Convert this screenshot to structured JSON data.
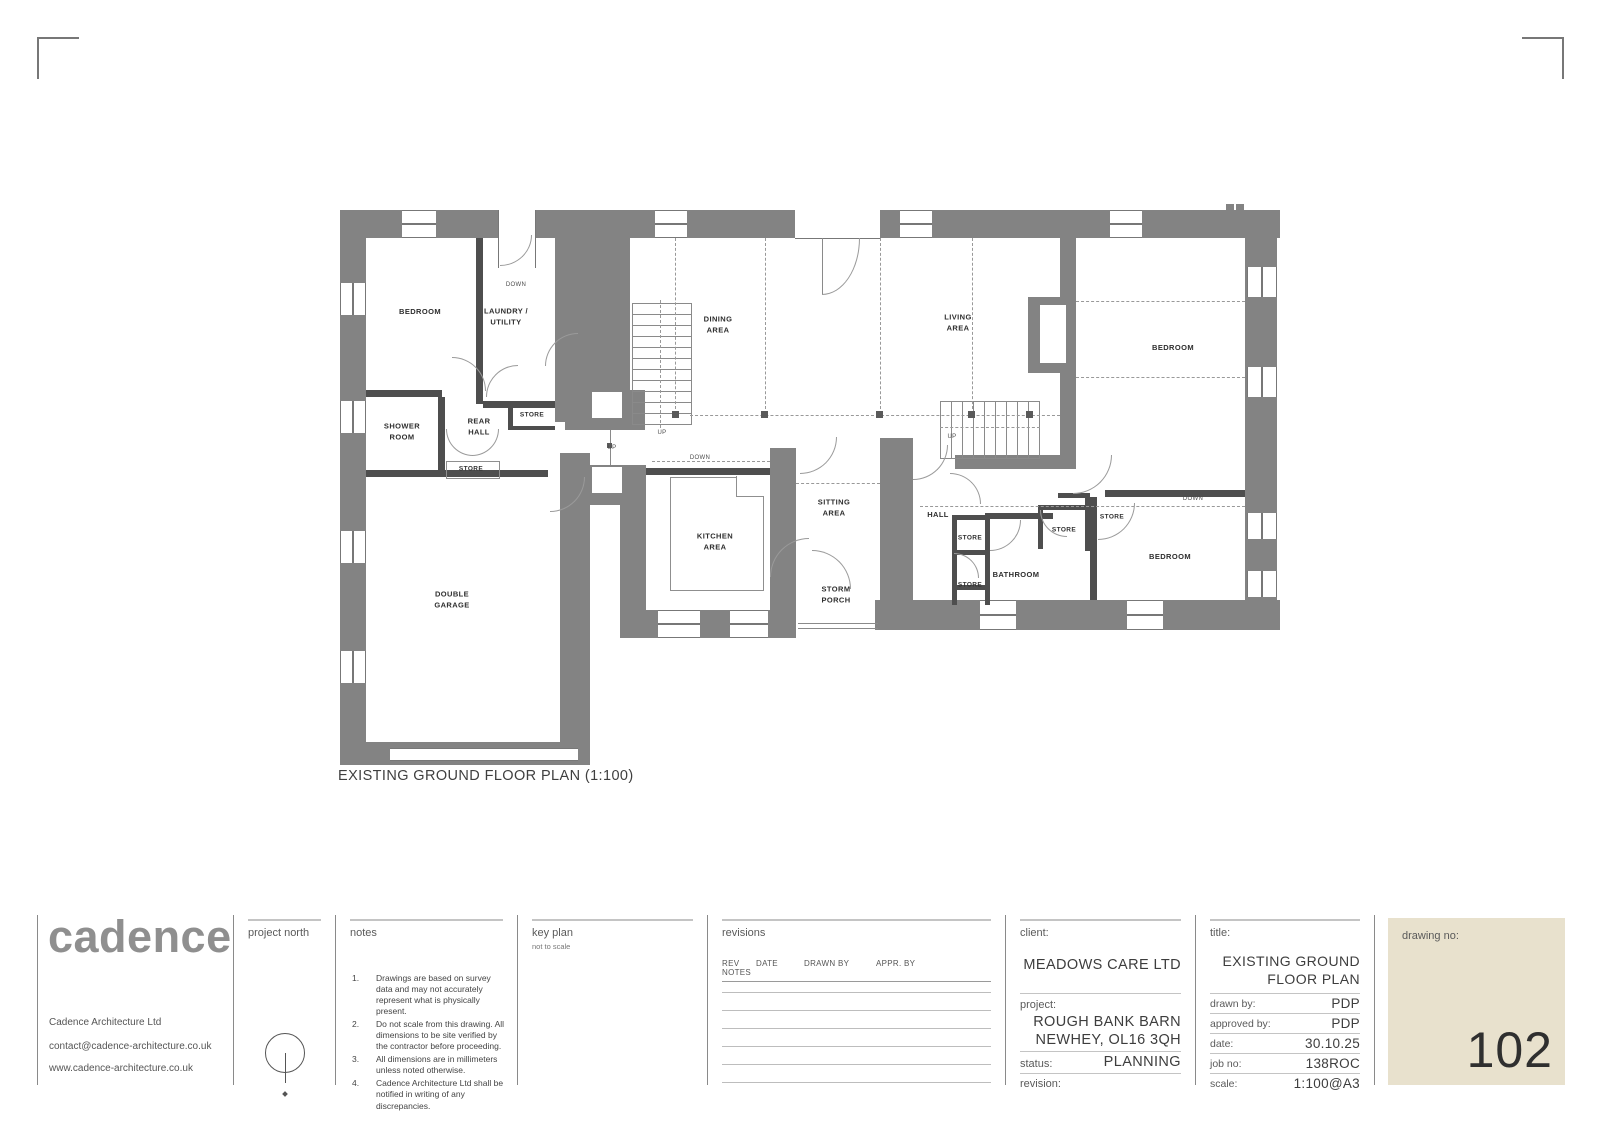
{
  "sheet": {
    "caption": "EXISTING GROUND FLOOR PLAN (1:100)"
  },
  "logo": {
    "name": "cadence",
    "company": "Cadence Architecture Ltd",
    "email": "contact@cadence-architecture.co.uk",
    "website": "www.cadence-architecture.co.uk"
  },
  "project_north": {
    "label": "project north"
  },
  "notes": {
    "label": "notes",
    "items": [
      "Drawings are based on survey data and may not accurately represent what is physically present.",
      "Do not scale from this drawing. All dimensions to be site verified by the contractor before proceeding.",
      "All dimensions are in millimeters unless noted otherwise.",
      "Cadence Architecture Ltd shall be notified in writing of any discrepancies."
    ]
  },
  "key_plan": {
    "label": "key plan",
    "sub": "not to scale"
  },
  "revisions": {
    "label": "revisions",
    "columns": [
      "REV",
      "DATE",
      "DRAWN BY",
      "APPR. BY",
      "NOTES"
    ],
    "empty_rows": 6
  },
  "client_block": {
    "label": "client:",
    "client": "MEADOWS CARE LTD",
    "project_label": "project:",
    "project_lines": "ROUGH BANK BARN\nNEWHEY, OL16 3QH",
    "status_label": "status:",
    "status": "PLANNING",
    "revision_label": "revision:",
    "revision": ""
  },
  "title_block": {
    "label": "title:",
    "title_lines": "EXISTING GROUND\nFLOOR PLAN",
    "fields": [
      {
        "label": "drawn by:",
        "value": "PDP"
      },
      {
        "label": "approved by:",
        "value": "PDP"
      },
      {
        "label": "date:",
        "value": "30.10.25"
      },
      {
        "label": "job no:",
        "value": "138ROC"
      },
      {
        "label": "scale:",
        "value": "1:100@A3"
      }
    ]
  },
  "drawing_no": {
    "label": "drawing no:",
    "number": "102"
  },
  "colors": {
    "wall": "#838383",
    "panel": "#e8e1cd"
  },
  "plan": {
    "rooms": [
      {
        "label": "BEDROOM",
        "x": 80,
        "y": 107
      },
      {
        "label": "LAUNDRY /\nUTILITY",
        "x": 166,
        "y": 112
      },
      {
        "label": "SHOWER\nROOM",
        "x": 62,
        "y": 227
      },
      {
        "label": "REAR\nHALL",
        "x": 139,
        "y": 222
      },
      {
        "label": "STORE",
        "x": 192,
        "y": 210,
        "small": true
      },
      {
        "label": "STORE",
        "x": 131,
        "y": 264,
        "small": true
      },
      {
        "label": "DOUBLE\nGARAGE",
        "x": 112,
        "y": 395
      },
      {
        "label": "DINING\nAREA",
        "x": 378,
        "y": 120
      },
      {
        "label": "LIVING\nAREA",
        "x": 618,
        "y": 118
      },
      {
        "label": "KITCHEN\nAREA",
        "x": 375,
        "y": 337
      },
      {
        "label": "SITTING\nAREA",
        "x": 494,
        "y": 303
      },
      {
        "label": "STORM\nPORCH",
        "x": 496,
        "y": 390
      },
      {
        "label": "HALL",
        "x": 598,
        "y": 310
      },
      {
        "label": "BEDROOM",
        "x": 833,
        "y": 143
      },
      {
        "label": "BEDROOM",
        "x": 830,
        "y": 352
      },
      {
        "label": "BATHROOM",
        "x": 676,
        "y": 370
      },
      {
        "label": "STORE",
        "x": 630,
        "y": 333,
        "small": true
      },
      {
        "label": "STORE",
        "x": 630,
        "y": 380,
        "small": true
      },
      {
        "label": "STORE",
        "x": 724,
        "y": 325,
        "small": true
      },
      {
        "label": "STORE",
        "x": 772,
        "y": 312,
        "small": true
      }
    ],
    "annotations": [
      {
        "text": "DOWN",
        "x": 176,
        "y": 80
      },
      {
        "text": "UP",
        "x": 322,
        "y": 228
      },
      {
        "text": "UP",
        "x": 272,
        "y": 243
      },
      {
        "text": "DOWN",
        "x": 360,
        "y": 253
      },
      {
        "text": "UP",
        "x": 612,
        "y": 232
      },
      {
        "text": "DOWN",
        "x": 853,
        "y": 294
      }
    ]
  }
}
